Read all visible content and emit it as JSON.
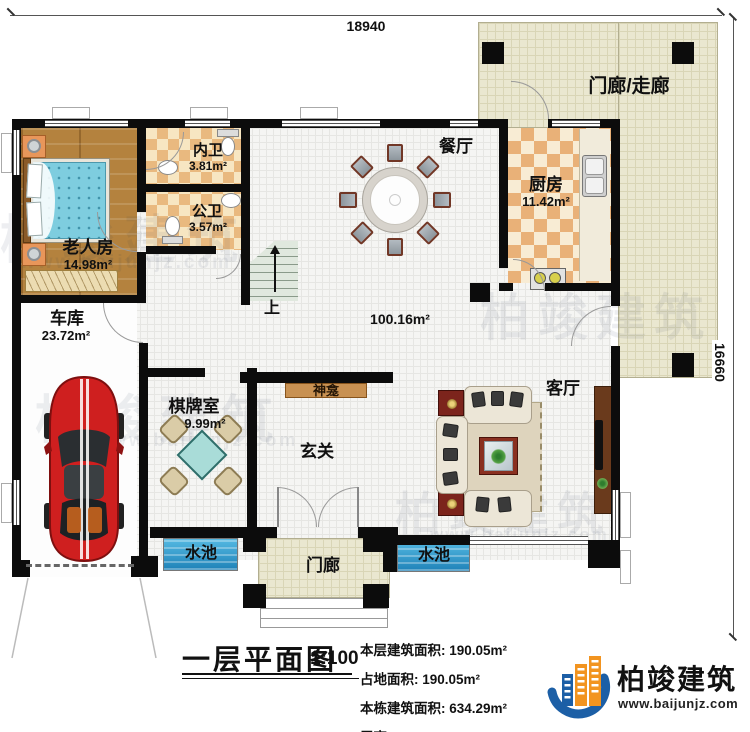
{
  "dimensions": {
    "top": "18940",
    "right": "16660"
  },
  "labels": {
    "porch_corridor": "门廊/走廊",
    "dining": "餐厅",
    "kitchen": "厨房",
    "kitchen_area": "11.42m²",
    "inner_bath": "内卫",
    "inner_bath_area": "3.81m²",
    "public_bath": "公卫",
    "public_bath_area": "3.57m²",
    "elder_room": "老人房",
    "elder_room_area": "14.98m²",
    "garage": "车库",
    "garage_area": "23.72m²",
    "chess_room": "棋牌室",
    "chess_room_area": "9.99m²",
    "shrine": "神龛",
    "foyer": "玄关",
    "living": "客厅",
    "hall_area": "100.16m²",
    "porch": "门廊",
    "pool_left": "水池",
    "pool_right": "水池",
    "stairs_up": "上"
  },
  "title_block": {
    "title": "一层平面图",
    "scale": "1:100",
    "stats": [
      {
        "label": "本层建筑面积:",
        "value": "190.05m²"
      },
      {
        "label": "占地面积:",
        "value": "190.05m²"
      },
      {
        "label": "本栋建筑面积:",
        "value": "634.29m²"
      },
      {
        "label": "层高:",
        "value": "4.2m"
      }
    ]
  },
  "branding": {
    "name": "柏竣建筑",
    "website": "www.baijunjz.com"
  },
  "watermark": {
    "text": "柏竣建筑",
    "site": "www.baijunjz.com"
  },
  "colors": {
    "accent_blue": "#1c5fa6",
    "accent_orange": "#f29420",
    "water": "#2e9fd0",
    "wall": "#0c0c0c"
  }
}
